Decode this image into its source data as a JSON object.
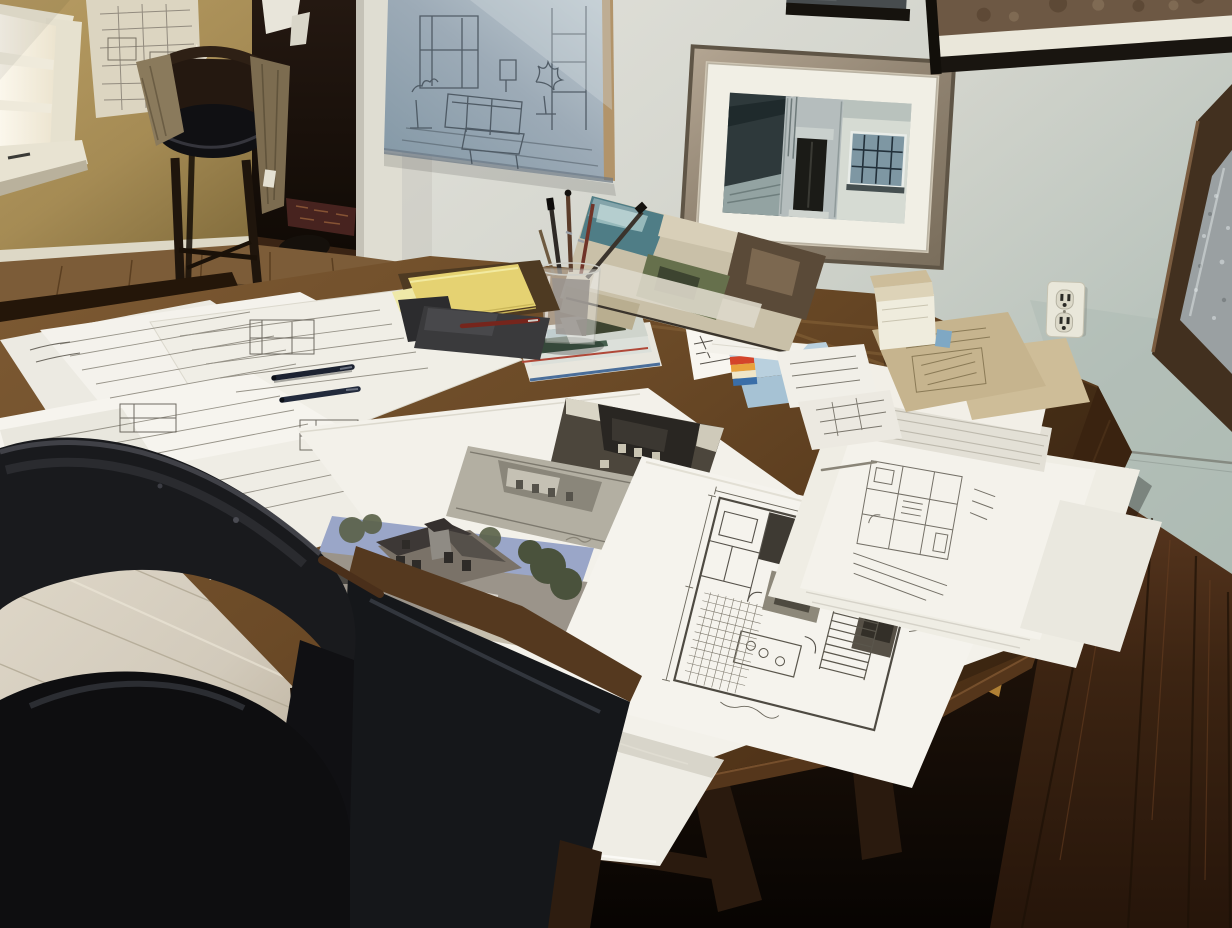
{
  "image_type": "photograph",
  "scene": {
    "description": "Home architecture studio viewed from above: a dark wood dining table is covered with hand-drawn pencil floor plans, sketch sheets and photographic prints of houses. Framed drawings and a framed photo of a stone building hang on pale green-gray walls; a muted yellow wall with a bright window and a wooden chair with draped fabric stand at the back left beside a dark doorway. Two black leather chairs sit in the foreground over light washed-oak and dark red-brown hardwood floors.",
    "lighting": "daylight entering from the window at far left",
    "camera": "elevated three-quarter view looking down across the worktable"
  },
  "palette": {
    "wall_yellow": "#ab9159",
    "wall_main_light": "#dedcd4",
    "wall_main_green": "#b2bfb7",
    "sketch_panel_blue": "#93a3b0",
    "frame_bronze": "#988b78",
    "frame_black": "#17130e",
    "mirror_wood": "#42301f",
    "table_wood": "#6e4c29",
    "table_wood_dark": "#3a2412",
    "paper_white": "#f3f1ea",
    "kraft_tan": "#c6b48e",
    "notepad_yellow": "#e5d272",
    "box_blue": "#aac6da",
    "pen_navy": "#1e2532",
    "pen_red": "#76251c",
    "leather_black": "#131417",
    "floor_light": "#d6cfc2",
    "floor_dark": "#36200f",
    "floor_gold_patch": "#b08034",
    "rug_maroon": "#47231f",
    "photo_sky": "#9aa6c8"
  },
  "objects": [
    {
      "id": "window",
      "label": "bright window with white trim and sill, far left"
    },
    {
      "id": "yellow-wall",
      "label": "muted gold wall at back left"
    },
    {
      "id": "pinned-plan",
      "label": "plan sketch pinned to the yellow wall"
    },
    {
      "id": "doorway",
      "label": "dark doorway opening to a hall"
    },
    {
      "id": "hall-rug",
      "label": "dark patterned rug seen through the doorway"
    },
    {
      "id": "wooden-chair",
      "label": "dark wooden chair with black seat and tan fabric draped over its back"
    },
    {
      "id": "wall-sketch-panel",
      "label": "large blue-gray interior sketch panel on the wall"
    },
    {
      "id": "framed-building-photo",
      "label": "bronze-framed, white-matted photo of a stone building entrance"
    },
    {
      "id": "framed-art-top-right",
      "label": "black-framed brown artwork at top right"
    },
    {
      "id": "framed-art-top-center",
      "label": "corner of a dark frame at top center"
    },
    {
      "id": "wood-framed-mirror",
      "label": "tilted dark wood framed mirror at right edge"
    },
    {
      "id": "power-outlet",
      "label": "white duplex power outlet on the wall"
    },
    {
      "id": "work-table",
      "label": "large dark wood worktable"
    },
    {
      "id": "drawing-sheets-left",
      "label": "pile of pencil floor-plan sheets on the left of the table"
    },
    {
      "id": "navy-pens",
      "label": "two dark navy pens lying on the sketches"
    },
    {
      "id": "photo-reference-sheet",
      "label": "large sheet holding three house photographs"
    },
    {
      "id": "house-photo-color",
      "label": "photo of a Victorian house with pale blue sky"
    },
    {
      "id": "house-photo-gray",
      "label": "faded gray photo of a house"
    },
    {
      "id": "house-photo-dark",
      "label": "dark black-and-white house photo"
    },
    {
      "id": "floor-plan-sheet",
      "label": "large detailed pencil floor plan with dark poche and tile hatching"
    },
    {
      "id": "overhanging-sheet",
      "label": "white sheet draped over the front table edge"
    },
    {
      "id": "drawing-sheets-right",
      "label": "more plan sheets at the right end of the table"
    },
    {
      "id": "kraft-folders",
      "label": "tan kraft brochures stacked on white paper"
    },
    {
      "id": "paper-stack",
      "label": "thick stack of white paper"
    },
    {
      "id": "small-box",
      "label": "small white and kraft box"
    },
    {
      "id": "blue-box",
      "label": "light blue box with a colorful label"
    },
    {
      "id": "handwritten-letter",
      "label": "handwritten letter with a brown stamp mark"
    },
    {
      "id": "folded-sketch",
      "label": "folded sketch card standing like a tent"
    },
    {
      "id": "magazine-stack",
      "label": "stack of magazines and color prints"
    },
    {
      "id": "collage-print",
      "label": "leaning collage art print in teal, green and umber"
    },
    {
      "id": "pen-cup",
      "label": "glass cup holding pens and brushes"
    },
    {
      "id": "yellow-notepad",
      "label": "yellow legal pad on a dark clipboard"
    },
    {
      "id": "dark-notebook",
      "label": "dark notebook with a red pen on top"
    },
    {
      "id": "leather-chair-front",
      "label": "black leather chair back, foreground left"
    },
    {
      "id": "leather-chair-second",
      "label": "second black leather chair with wood rail"
    },
    {
      "id": "light-wood-floor",
      "label": "light washed hardwood floor, bottom left"
    },
    {
      "id": "dark-wood-floor",
      "label": "dark red-brown hardwood floor, right"
    },
    {
      "id": "golden-floor-patch",
      "label": "golden wood patch visible under the table"
    }
  ]
}
